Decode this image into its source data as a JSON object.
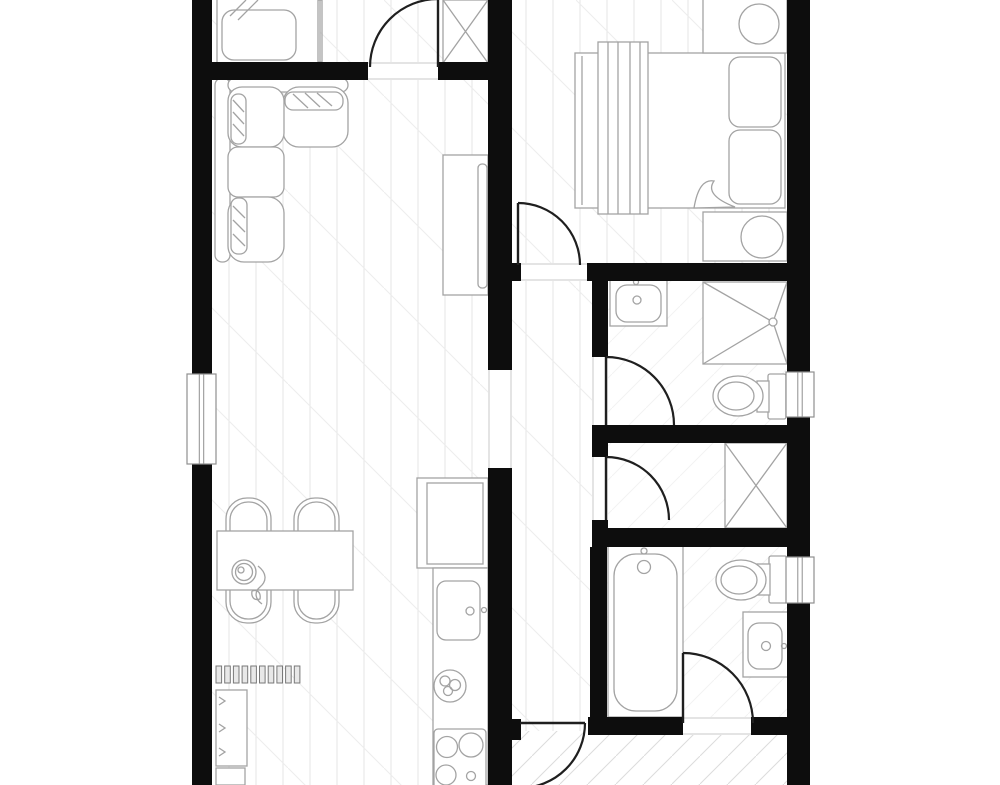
{
  "app": {
    "title": "apartment-floor-plan",
    "canvas": {
      "width": 1000,
      "height": 785,
      "background": "#ffffff"
    }
  },
  "colors": {
    "wall": "#0d0d0d",
    "door": "#1f1f1f",
    "furniture": "#a3a3a3",
    "threshold": "#c9c9c9",
    "window_frame": "#8f8f8f",
    "floor_plank": "#e4e4e4",
    "floor_diag": "#ededed",
    "hatch": "#dcdcdc",
    "bath_tile": "#f2f2f2",
    "radiator": "#787878",
    "fill": "#ffffff"
  },
  "floors": [
    {
      "name": "floor-top-room",
      "type": "wood",
      "x": 212,
      "y": 0,
      "w": 276,
      "h": 62
    },
    {
      "name": "floor-living-room",
      "type": "wood",
      "x": 212,
      "y": 80,
      "w": 276,
      "h": 705
    },
    {
      "name": "floor-bedroom",
      "type": "wood",
      "x": 512,
      "y": 0,
      "w": 275,
      "h": 263
    },
    {
      "name": "floor-hallway",
      "type": "wood",
      "x": 512,
      "y": 281,
      "w": 80,
      "h": 450
    },
    {
      "name": "floor-entry",
      "type": "hatch",
      "x": 512,
      "y": 731,
      "w": 76,
      "h": 54
    },
    {
      "name": "floor-bottom-right",
      "type": "hatch",
      "x": 588,
      "y": 735,
      "w": 199,
      "h": 50
    },
    {
      "name": "floor-bathroom-1",
      "type": "bath",
      "x": 608,
      "y": 281,
      "w": 179,
      "h": 144
    },
    {
      "name": "floor-closet-hall",
      "type": "bath",
      "x": 608,
      "y": 443,
      "w": 179,
      "h": 85
    },
    {
      "name": "floor-bathroom-2",
      "type": "bath",
      "x": 607,
      "y": 547,
      "w": 180,
      "h": 170
    }
  ],
  "walls": [
    {
      "name": "wall-left-upper",
      "x": 192,
      "y": 0,
      "w": 20,
      "h": 374
    },
    {
      "name": "wall-left-lower",
      "x": 192,
      "y": 464,
      "w": 20,
      "h": 321
    },
    {
      "name": "wall-right-upper",
      "x": 787,
      "y": 0,
      "w": 23,
      "h": 372
    },
    {
      "name": "wall-right-mid",
      "x": 787,
      "y": 417,
      "w": 23,
      "h": 140
    },
    {
      "name": "wall-right-lower",
      "x": 787,
      "y": 603,
      "w": 23,
      "h": 182
    },
    {
      "name": "wall-top-room-south-a",
      "x": 192,
      "y": 62,
      "w": 176,
      "h": 18
    },
    {
      "name": "wall-top-room-south-b",
      "x": 438,
      "y": 62,
      "w": 74,
      "h": 18
    },
    {
      "name": "wall-center-upper",
      "x": 488,
      "y": 0,
      "w": 24,
      "h": 370
    },
    {
      "name": "wall-center-lower",
      "x": 488,
      "y": 468,
      "w": 24,
      "h": 317
    },
    {
      "name": "wall-bedroom-south",
      "x": 587,
      "y": 263,
      "w": 200,
      "h": 18
    },
    {
      "name": "wall-bedroom-south-stub",
      "x": 510,
      "y": 263,
      "w": 11,
      "h": 18
    },
    {
      "name": "wall-bath1-west",
      "x": 592,
      "y": 281,
      "w": 16,
      "h": 76
    },
    {
      "name": "wall-bath1-west-stub",
      "x": 592,
      "y": 425,
      "w": 16,
      "h": 32
    },
    {
      "name": "wall-bath1-south",
      "x": 592,
      "y": 425,
      "w": 195,
      "h": 18
    },
    {
      "name": "wall-closet-hall-stub",
      "x": 592,
      "y": 520,
      "w": 16,
      "h": 27
    },
    {
      "name": "wall-closet-hall-south",
      "x": 592,
      "y": 528,
      "w": 195,
      "h": 19
    },
    {
      "name": "wall-bath2-west",
      "x": 590,
      "y": 547,
      "w": 17,
      "h": 188
    },
    {
      "name": "wall-bath2-south-a",
      "x": 588,
      "y": 717,
      "w": 95,
      "h": 18
    },
    {
      "name": "wall-bath2-south-b",
      "x": 751,
      "y": 717,
      "w": 36,
      "h": 18
    },
    {
      "name": "wall-entry-door-stub",
      "x": 510,
      "y": 719,
      "w": 11,
      "h": 21
    }
  ],
  "windows": [
    {
      "name": "window-left",
      "x": 187,
      "y": 374,
      "w": 29,
      "h": 90
    },
    {
      "name": "window-right-top",
      "x": 786,
      "y": 372,
      "w": 28,
      "h": 45
    },
    {
      "name": "window-right-low",
      "x": 786,
      "y": 557,
      "w": 28,
      "h": 46
    }
  ],
  "thresholds": [
    {
      "name": "threshold-top-door",
      "x1": 368,
      "y1": 63,
      "x2": 438,
      "y2": 63
    },
    {
      "name": "threshold-top-door-2",
      "x1": 368,
      "y1": 79,
      "x2": 438,
      "y2": 79
    },
    {
      "name": "threshold-bedroom",
      "x1": 521,
      "y1": 264,
      "x2": 587,
      "y2": 264
    },
    {
      "name": "threshold-bedroom-2",
      "x1": 521,
      "y1": 280,
      "x2": 587,
      "y2": 280
    },
    {
      "name": "threshold-bath1",
      "x1": 593,
      "y1": 357,
      "x2": 593,
      "y2": 425
    },
    {
      "name": "threshold-bath1-2",
      "x1": 607,
      "y1": 357,
      "x2": 607,
      "y2": 425
    },
    {
      "name": "threshold-closet-hall",
      "x1": 593,
      "y1": 457,
      "x2": 593,
      "y2": 520
    },
    {
      "name": "threshold-closet-hall-2",
      "x1": 607,
      "y1": 457,
      "x2": 607,
      "y2": 520
    },
    {
      "name": "threshold-bath2",
      "x1": 683,
      "y1": 718,
      "x2": 751,
      "y2": 718
    },
    {
      "name": "threshold-bath2-2",
      "x1": 683,
      "y1": 734,
      "x2": 751,
      "y2": 734
    },
    {
      "name": "threshold-passage",
      "x1": 489,
      "y1": 370,
      "x2": 489,
      "y2": 468
    },
    {
      "name": "threshold-passage-2",
      "x1": 511,
      "y1": 370,
      "x2": 511,
      "y2": 468
    }
  ],
  "doors": [
    {
      "name": "door-top-room",
      "leaf": "M438,67 L438,-1",
      "arc": "M370,67 A68,68 0 0 1 438,-1"
    },
    {
      "name": "door-bedroom",
      "leaf": "M518,265 L518,203",
      "arc": "M518,203 A62,62 0 0 1 580,265"
    },
    {
      "name": "door-bathroom-1",
      "leaf": "M606,425 L606,357",
      "arc": "M606,357 A68,68 0 0 1 674,425"
    },
    {
      "name": "door-closet-hall",
      "leaf": "M606,520 L606,457",
      "arc": "M606,457 A63,63 0 0 1 669,520"
    },
    {
      "name": "door-bathroom-2",
      "leaf": "M683,723 L683,653",
      "arc": "M683,653 A70,70 0 0 1 753,723"
    },
    {
      "name": "door-entry",
      "leaf": "M520,723 L585,723",
      "arc": "M585,723 A65,65 0 0 1 520,788"
    }
  ],
  "furniture": [
    {
      "name": "bed-top-room",
      "parts": [
        {
          "t": "rect",
          "x": 217,
          "y": -8,
          "w": 103,
          "h": 73
        },
        {
          "t": "rect",
          "x": 222,
          "y": 10,
          "w": 74,
          "h": 50,
          "rx": 12
        },
        {
          "t": "path",
          "d": "M246,0 L230,16 M258,0 L238,20"
        },
        {
          "t": "rect",
          "x": 318,
          "y": 0,
          "w": 4,
          "h": 62,
          "fill": "none"
        }
      ]
    },
    {
      "name": "closet-top",
      "parts": [
        {
          "t": "rect",
          "x": 443,
          "y": 0,
          "w": 45,
          "h": 63
        },
        {
          "t": "path",
          "d": "M443,0 L488,63 M488,0 L443,63"
        }
      ]
    },
    {
      "name": "sofa-sectional",
      "parts": [
        {
          "t": "rect",
          "x": 215,
          "y": 78,
          "w": 15,
          "h": 184,
          "rx": 7
        },
        {
          "t": "rect",
          "x": 228,
          "y": 78,
          "w": 120,
          "h": 14,
          "rx": 7
        },
        {
          "t": "rect",
          "x": 283,
          "y": 87,
          "w": 65,
          "h": 60,
          "rx": 16
        },
        {
          "t": "rect",
          "x": 228,
          "y": 87,
          "w": 56,
          "h": 60,
          "rx": 14
        },
        {
          "t": "rect",
          "x": 228,
          "y": 147,
          "w": 56,
          "h": 50,
          "rx": 10
        },
        {
          "t": "rect",
          "x": 228,
          "y": 197,
          "w": 56,
          "h": 65,
          "rx": 16
        },
        {
          "t": "rect",
          "x": 231,
          "y": 94,
          "w": 15,
          "h": 50,
          "rx": 7
        },
        {
          "t": "path",
          "d": "M233,100 L244,112 M233,112 L244,124 M233,124 L244,136"
        },
        {
          "t": "rect",
          "x": 285,
          "y": 92,
          "w": 58,
          "h": 18,
          "rx": 8
        },
        {
          "t": "path",
          "d": "M293,94 L308,108 M305,93 L320,107 M317,93 L332,106"
        },
        {
          "t": "rect",
          "x": 231,
          "y": 198,
          "w": 16,
          "h": 56,
          "rx": 7
        },
        {
          "t": "path",
          "d": "M233,206 L245,218 M233,220 L245,232 M233,234 L245,246"
        }
      ]
    },
    {
      "name": "tv-cabinet",
      "parts": [
        {
          "t": "rect",
          "x": 443,
          "y": 155,
          "w": 45,
          "h": 140
        },
        {
          "t": "rect",
          "x": 478,
          "y": 164,
          "w": 9,
          "h": 124,
          "rx": 4
        }
      ]
    },
    {
      "name": "bed-main",
      "parts": [
        {
          "t": "rect",
          "x": 575,
          "y": 53,
          "w": 210,
          "h": 155
        },
        {
          "t": "line",
          "x1": 582,
          "y1": 56,
          "x2": 582,
          "y2": 205
        },
        {
          "t": "rect",
          "x": 598,
          "y": 42,
          "w": 50,
          "h": 172
        },
        {
          "t": "path",
          "d": "M608,42 V214 M618,42 V214 M630,42 V214 M640,42 V214"
        },
        {
          "t": "rect",
          "x": 729,
          "y": 57,
          "w": 52,
          "h": 70,
          "rx": 11
        },
        {
          "t": "rect",
          "x": 729,
          "y": 130,
          "w": 52,
          "h": 74,
          "rx": 11
        },
        {
          "t": "path",
          "d": "M694,208 Q699,178 714,181 Q704,195 735,207 Z",
          "fill": "#ffffff"
        }
      ]
    },
    {
      "name": "nightstand-top",
      "parts": [
        {
          "t": "rect",
          "x": 703,
          "y": -6,
          "w": 84,
          "h": 59
        },
        {
          "t": "circle",
          "cx": 759,
          "cy": 24,
          "r": 20
        }
      ]
    },
    {
      "name": "nightstand-bottom",
      "parts": [
        {
          "t": "rect",
          "x": 703,
          "y": 212,
          "w": 84,
          "h": 49
        },
        {
          "t": "circle",
          "cx": 762,
          "cy": 237,
          "r": 21
        }
      ]
    },
    {
      "name": "sink-bathroom-1",
      "parts": [
        {
          "t": "rect",
          "x": 610,
          "y": 278,
          "w": 57,
          "h": 48
        },
        {
          "t": "rect",
          "x": 616,
          "y": 285,
          "w": 45,
          "h": 37,
          "rx": 11
        },
        {
          "t": "circle",
          "cx": 636,
          "cy": 282,
          "r": 2.5
        },
        {
          "t": "circle",
          "cx": 637,
          "cy": 300,
          "r": 4
        }
      ]
    },
    {
      "name": "shower",
      "parts": [
        {
          "t": "rect",
          "x": 703,
          "y": 282,
          "w": 84,
          "h": 82
        },
        {
          "t": "path",
          "d": "M703,282 L773,322 M787,282 L773,322 M703,364 L773,322 M787,364 L773,322"
        },
        {
          "t": "circle",
          "cx": 773,
          "cy": 322,
          "r": 4,
          "fill": "#ffffff"
        }
      ]
    },
    {
      "name": "toilet-bathroom-1",
      "parts": [
        {
          "t": "rect",
          "x": 768,
          "y": 374,
          "w": 18,
          "h": 45,
          "rx": 2
        },
        {
          "t": "rect",
          "x": 757,
          "y": 381,
          "w": 12,
          "h": 31
        },
        {
          "t": "ellipse",
          "cx": 738,
          "cy": 396,
          "rx": 25,
          "ry": 20
        },
        {
          "t": "ellipse",
          "cx": 736,
          "cy": 396,
          "rx": 18,
          "ry": 14
        }
      ]
    },
    {
      "name": "closet-hallway",
      "parts": [
        {
          "t": "rect",
          "x": 725,
          "y": 443,
          "w": 62,
          "h": 85
        },
        {
          "t": "path",
          "d": "M725,443 L787,528 M787,443 L725,528"
        }
      ]
    },
    {
      "name": "bathtub",
      "parts": [
        {
          "t": "rect",
          "x": 608,
          "y": 545,
          "w": 75,
          "h": 172
        },
        {
          "t": "rect",
          "x": 614,
          "y": 554,
          "w": 63,
          "h": 157,
          "rx": 22
        },
        {
          "t": "circle",
          "cx": 644,
          "cy": 551,
          "r": 3
        },
        {
          "t": "circle",
          "cx": 644,
          "cy": 567,
          "r": 6.5
        }
      ]
    },
    {
      "name": "toilet-bathroom-2",
      "parts": [
        {
          "t": "rect",
          "x": 769,
          "y": 556,
          "w": 18,
          "h": 47,
          "rx": 2
        },
        {
          "t": "rect",
          "x": 757,
          "y": 564,
          "w": 13,
          "h": 31
        },
        {
          "t": "ellipse",
          "cx": 741,
          "cy": 580,
          "rx": 25,
          "ry": 20
        },
        {
          "t": "ellipse",
          "cx": 739,
          "cy": 580,
          "rx": 18,
          "ry": 14
        }
      ]
    },
    {
      "name": "sink-bathroom-2",
      "parts": [
        {
          "t": "rect",
          "x": 743,
          "y": 612,
          "w": 45,
          "h": 65
        },
        {
          "t": "rect",
          "x": 748,
          "y": 623,
          "w": 34,
          "h": 46,
          "rx": 11
        },
        {
          "t": "circle",
          "cx": 766,
          "cy": 646,
          "r": 4.5
        },
        {
          "t": "circle",
          "cx": 784,
          "cy": 646,
          "r": 2.5
        }
      ]
    },
    {
      "name": "kitchen-fridge",
      "parts": [
        {
          "t": "rect",
          "x": 417,
          "y": 478,
          "w": 71,
          "h": 90
        },
        {
          "t": "rect",
          "x": 427,
          "y": 483,
          "w": 56,
          "h": 81
        }
      ]
    },
    {
      "name": "kitchen-counter",
      "parts": [
        {
          "t": "rect",
          "x": 433,
          "y": 568,
          "w": 55,
          "h": 217
        }
      ]
    },
    {
      "name": "kitchen-sink",
      "parts": [
        {
          "t": "rect",
          "x": 437,
          "y": 581,
          "w": 43,
          "h": 59,
          "rx": 9
        },
        {
          "t": "circle",
          "cx": 470,
          "cy": 611,
          "r": 4
        },
        {
          "t": "circle",
          "cx": 484,
          "cy": 610,
          "r": 2.5
        }
      ]
    },
    {
      "name": "fruit-bowl",
      "parts": [
        {
          "t": "circle",
          "cx": 450,
          "cy": 686,
          "r": 16
        },
        {
          "t": "circle",
          "cx": 445,
          "cy": 681,
          "r": 5
        },
        {
          "t": "circle",
          "cx": 455,
          "cy": 685,
          "r": 5.5
        },
        {
          "t": "circle",
          "cx": 448,
          "cy": 691,
          "r": 4.5
        }
      ]
    },
    {
      "name": "kitchen-stove",
      "parts": [
        {
          "t": "rect",
          "x": 434,
          "y": 729,
          "w": 52,
          "h": 70,
          "rx": 4
        },
        {
          "t": "circle",
          "cx": 447,
          "cy": 747,
          "r": 10.5
        },
        {
          "t": "circle",
          "cx": 471,
          "cy": 745,
          "r": 12
        },
        {
          "t": "circle",
          "cx": 446,
          "cy": 775,
          "r": 10
        },
        {
          "t": "circle",
          "cx": 471,
          "cy": 776,
          "r": 4.5
        }
      ]
    },
    {
      "name": "dining-chair-1",
      "parts": [
        {
          "t": "rect",
          "x": 226,
          "y": 498,
          "w": 45,
          "h": 76,
          "rx": 21
        },
        {
          "t": "rect",
          "x": 230,
          "y": 502,
          "w": 37,
          "h": 68,
          "rx": 18
        }
      ]
    },
    {
      "name": "dining-chair-2",
      "parts": [
        {
          "t": "rect",
          "x": 294,
          "y": 498,
          "w": 45,
          "h": 76,
          "rx": 21
        },
        {
          "t": "rect",
          "x": 298,
          "y": 502,
          "w": 37,
          "h": 68,
          "rx": 18
        }
      ]
    },
    {
      "name": "dining-chair-3",
      "parts": [
        {
          "t": "rect",
          "x": 226,
          "y": 547,
          "w": 45,
          "h": 76,
          "rx": 21
        },
        {
          "t": "rect",
          "x": 230,
          "y": 551,
          "w": 37,
          "h": 68,
          "rx": 18
        }
      ]
    },
    {
      "name": "dining-chair-4",
      "parts": [
        {
          "t": "rect",
          "x": 294,
          "y": 547,
          "w": 45,
          "h": 76,
          "rx": 21
        },
        {
          "t": "rect",
          "x": 298,
          "y": 551,
          "w": 37,
          "h": 68,
          "rx": 18
        }
      ]
    },
    {
      "name": "dining-table",
      "parts": [
        {
          "t": "rect",
          "x": 217,
          "y": 531,
          "w": 136,
          "h": 59
        },
        {
          "t": "circle",
          "cx": 244,
          "cy": 572,
          "r": 12
        },
        {
          "t": "circle",
          "cx": 244,
          "cy": 572,
          "r": 8.5
        },
        {
          "t": "circle",
          "cx": 241,
          "cy": 570,
          "r": 3
        },
        {
          "t": "path",
          "d": "M258,566 c9,7 9,15 2,21 c-6,5 -5,12 2,17 M252,591 c6,-2 9,2 8,8 c-6,2 -9,-2 -8,-8"
        }
      ]
    },
    {
      "name": "radiator",
      "parts": [
        {
          "t": "bars",
          "x": 216,
          "y": 666,
          "count": 10,
          "step": 8.7,
          "w": 5.6,
          "h": 17
        }
      ]
    },
    {
      "name": "shelf-unit",
      "parts": [
        {
          "t": "rect",
          "x": 216,
          "y": 690,
          "w": 31,
          "h": 76
        },
        {
          "t": "path",
          "d": "M219,697 l6,4 l-6,4 M219,724 l6,4 l-6,4 M219,748 l6,4 l-6,4"
        },
        {
          "t": "rect",
          "x": 216,
          "y": 768,
          "w": 29,
          "h": 17
        }
      ]
    }
  ]
}
